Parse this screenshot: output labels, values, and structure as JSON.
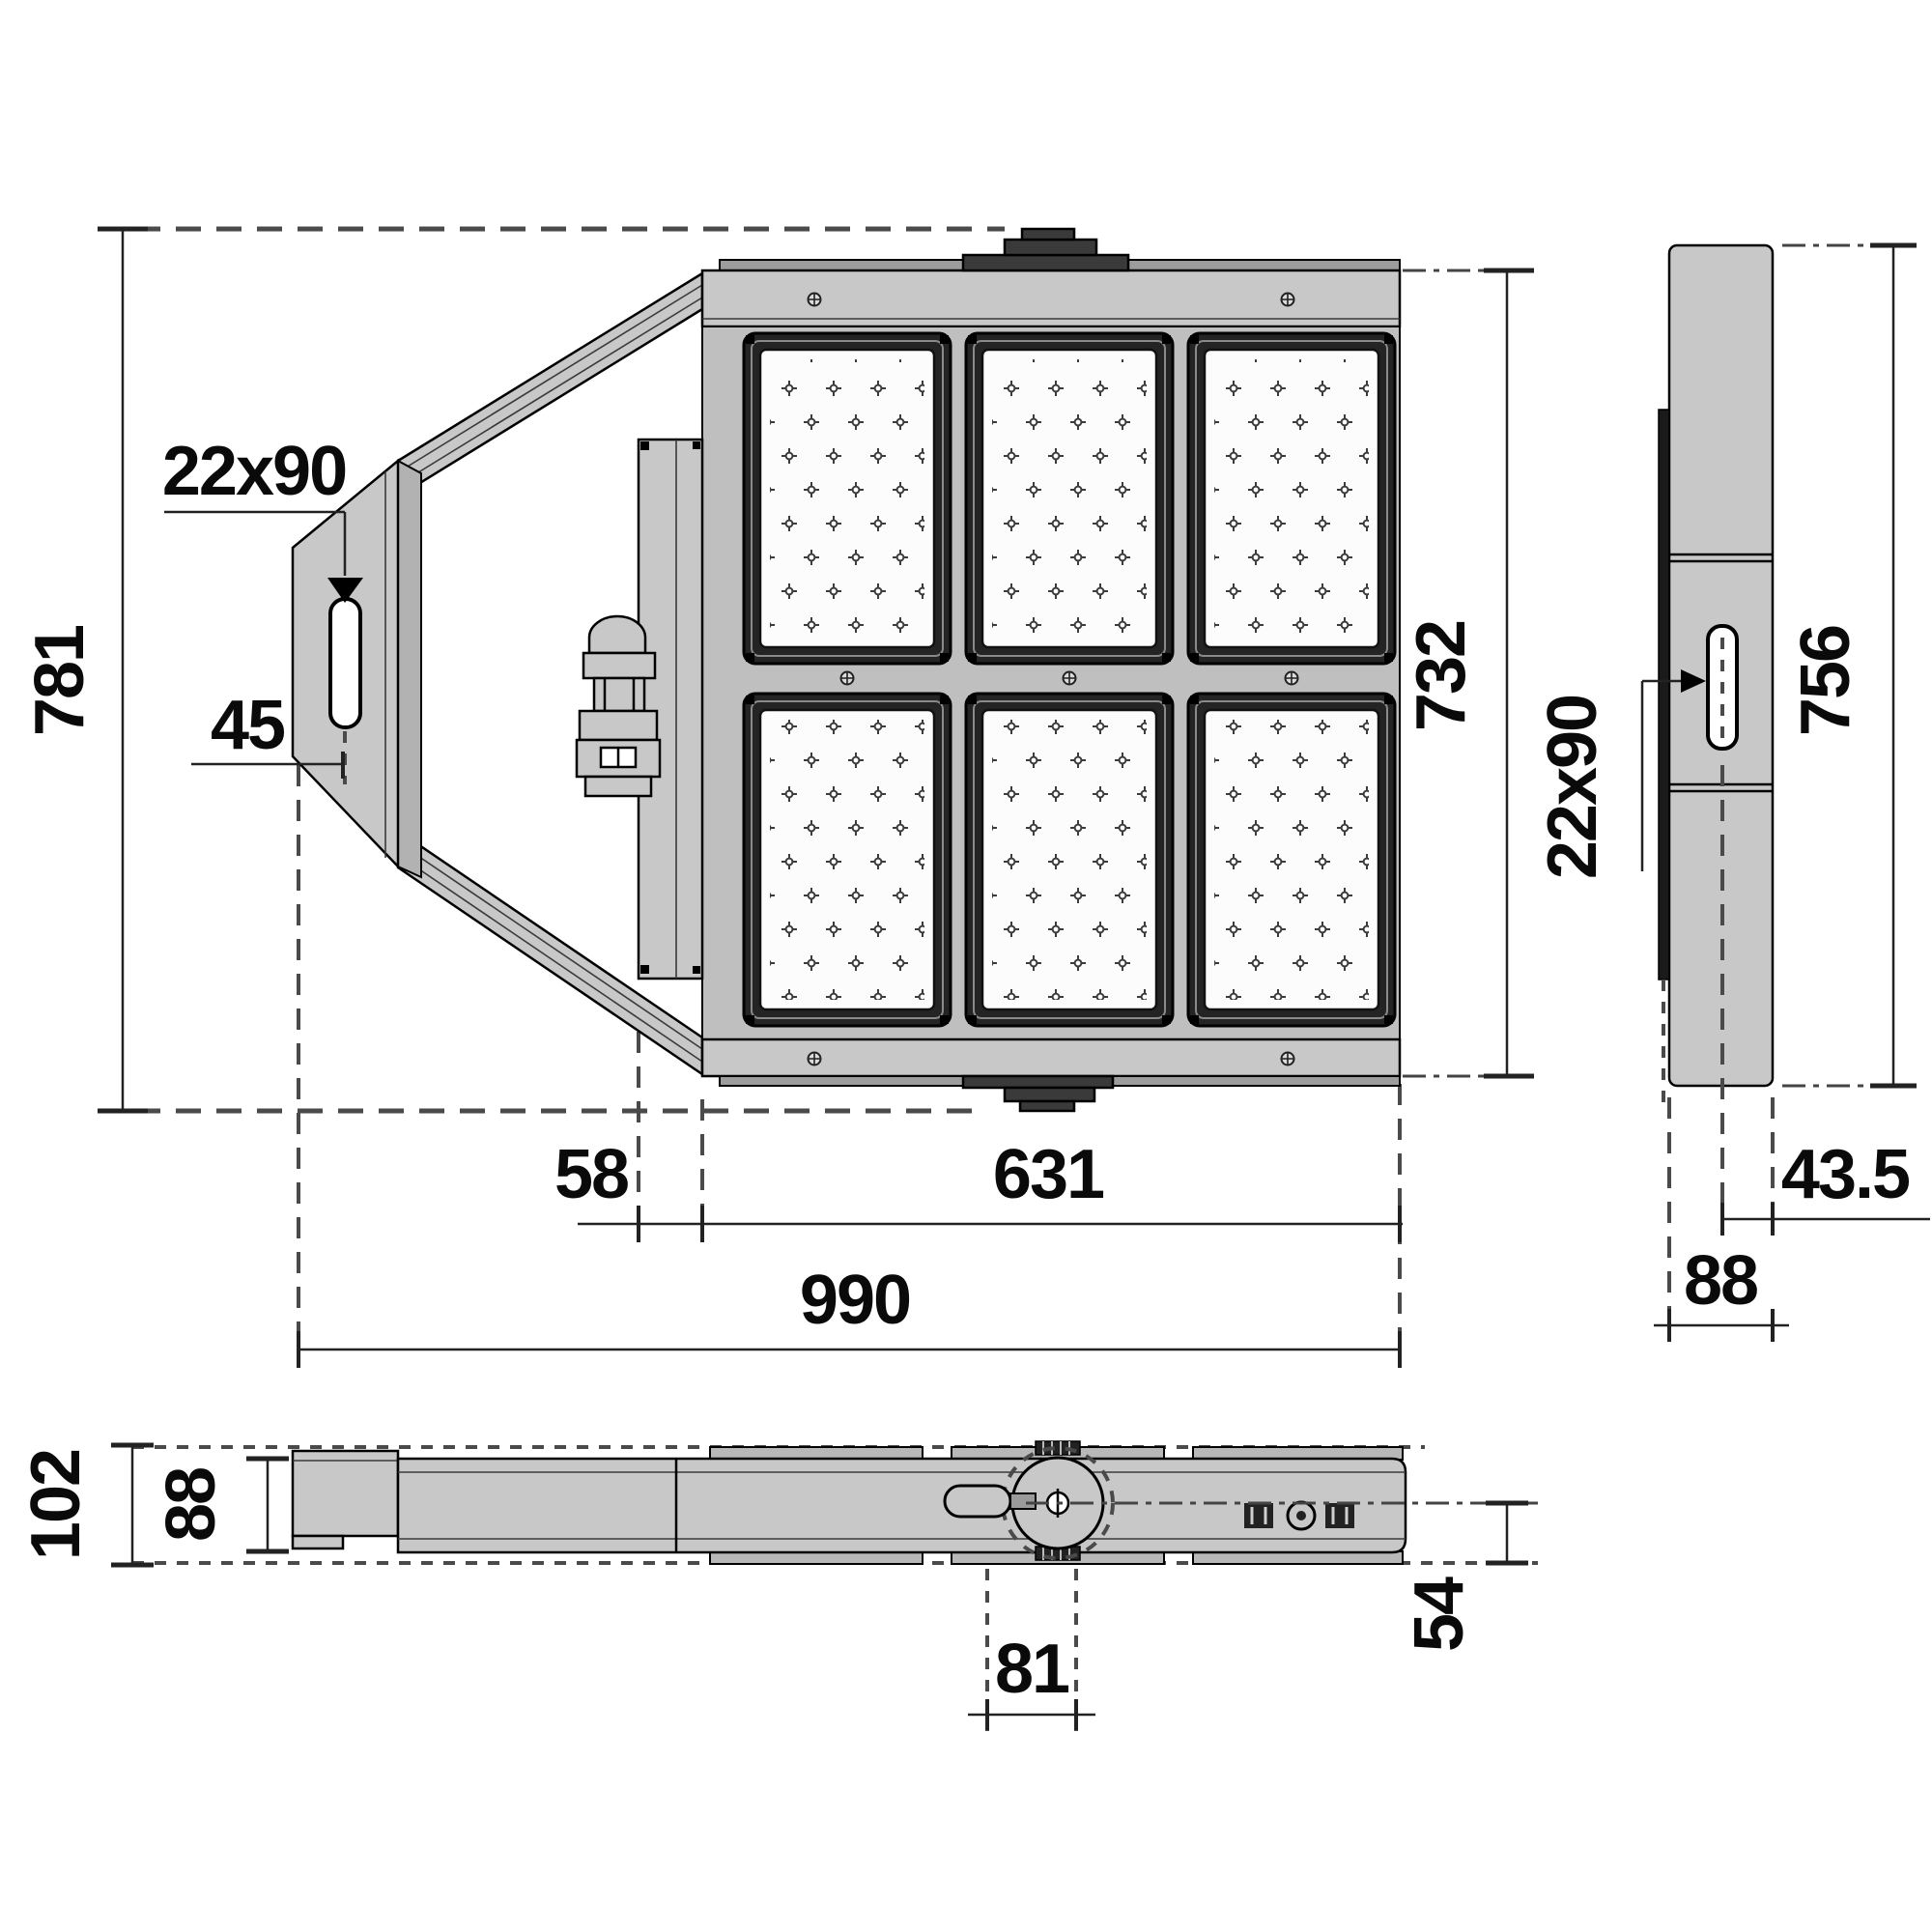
{
  "drawing": {
    "kind": "luminaire-dimension-drawing",
    "units": "mm",
    "views": {
      "front": {
        "overall_height": "781",
        "overall_width": "990",
        "body_height": "732",
        "body_width": "631",
        "bracket_offset": "58",
        "slot_size": "22x90",
        "slot_distance": "45"
      },
      "side": {
        "height": "756",
        "width": "88",
        "slot_size": "22x90",
        "center_to_face": "43.5"
      },
      "bottom": {
        "overall_depth": "102",
        "body_depth": "88",
        "pivot_offset": "81",
        "axis_to_edge": "54"
      }
    }
  }
}
